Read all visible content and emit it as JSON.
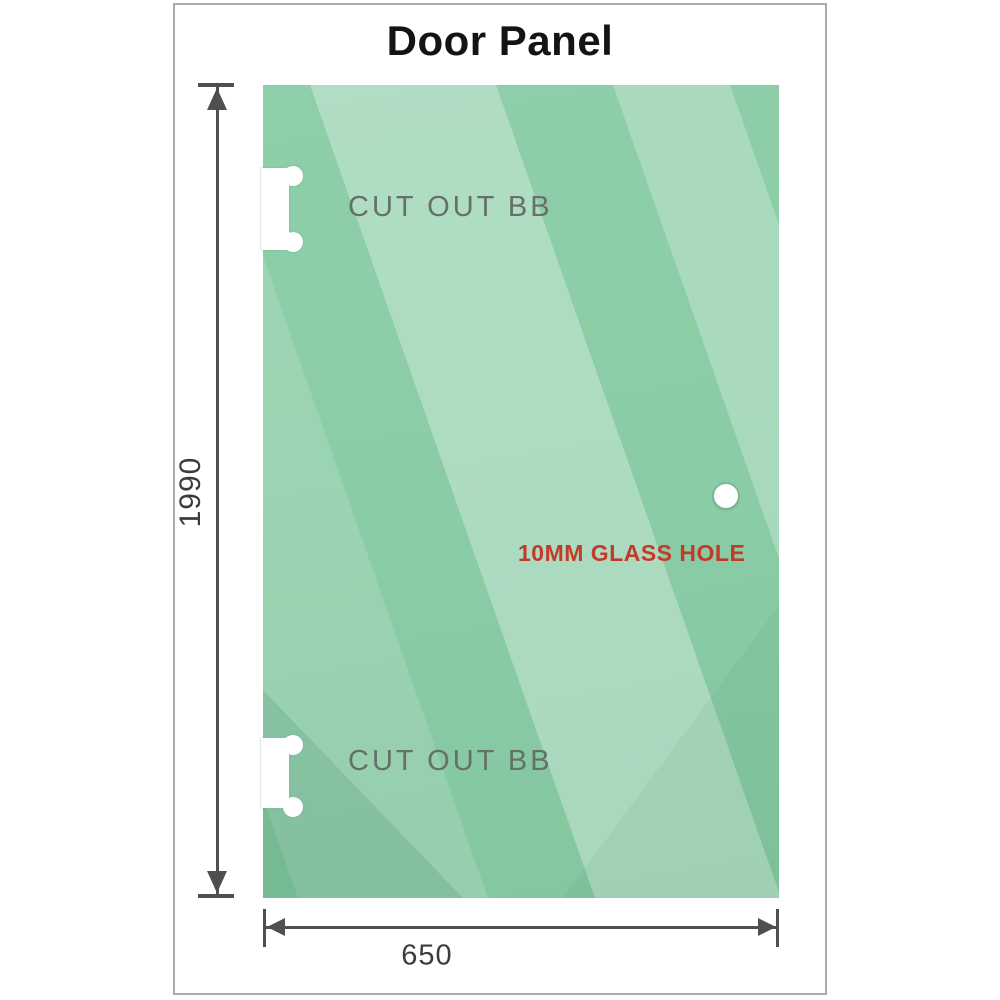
{
  "title": "Door Panel",
  "panel": {
    "cutout_top_label": "CUT OUT BB",
    "cutout_bottom_label": "CUT OUT BB",
    "glass_hole_label": "10MM GLASS HOLE"
  },
  "dimensions": {
    "height_label": "1990",
    "width_label": "650"
  },
  "colors": {
    "glass_base": "#8ecfa9",
    "glass_sheen_light": "#c0e6cd",
    "glass_corner_dark": "#7ec39b",
    "dimension_gray": "#4f4f4f",
    "annotation_red": "#c23b2a",
    "cutout_label_gray": "#66706b",
    "frame_border_gray": "#ababab",
    "title_text": "#141414"
  }
}
